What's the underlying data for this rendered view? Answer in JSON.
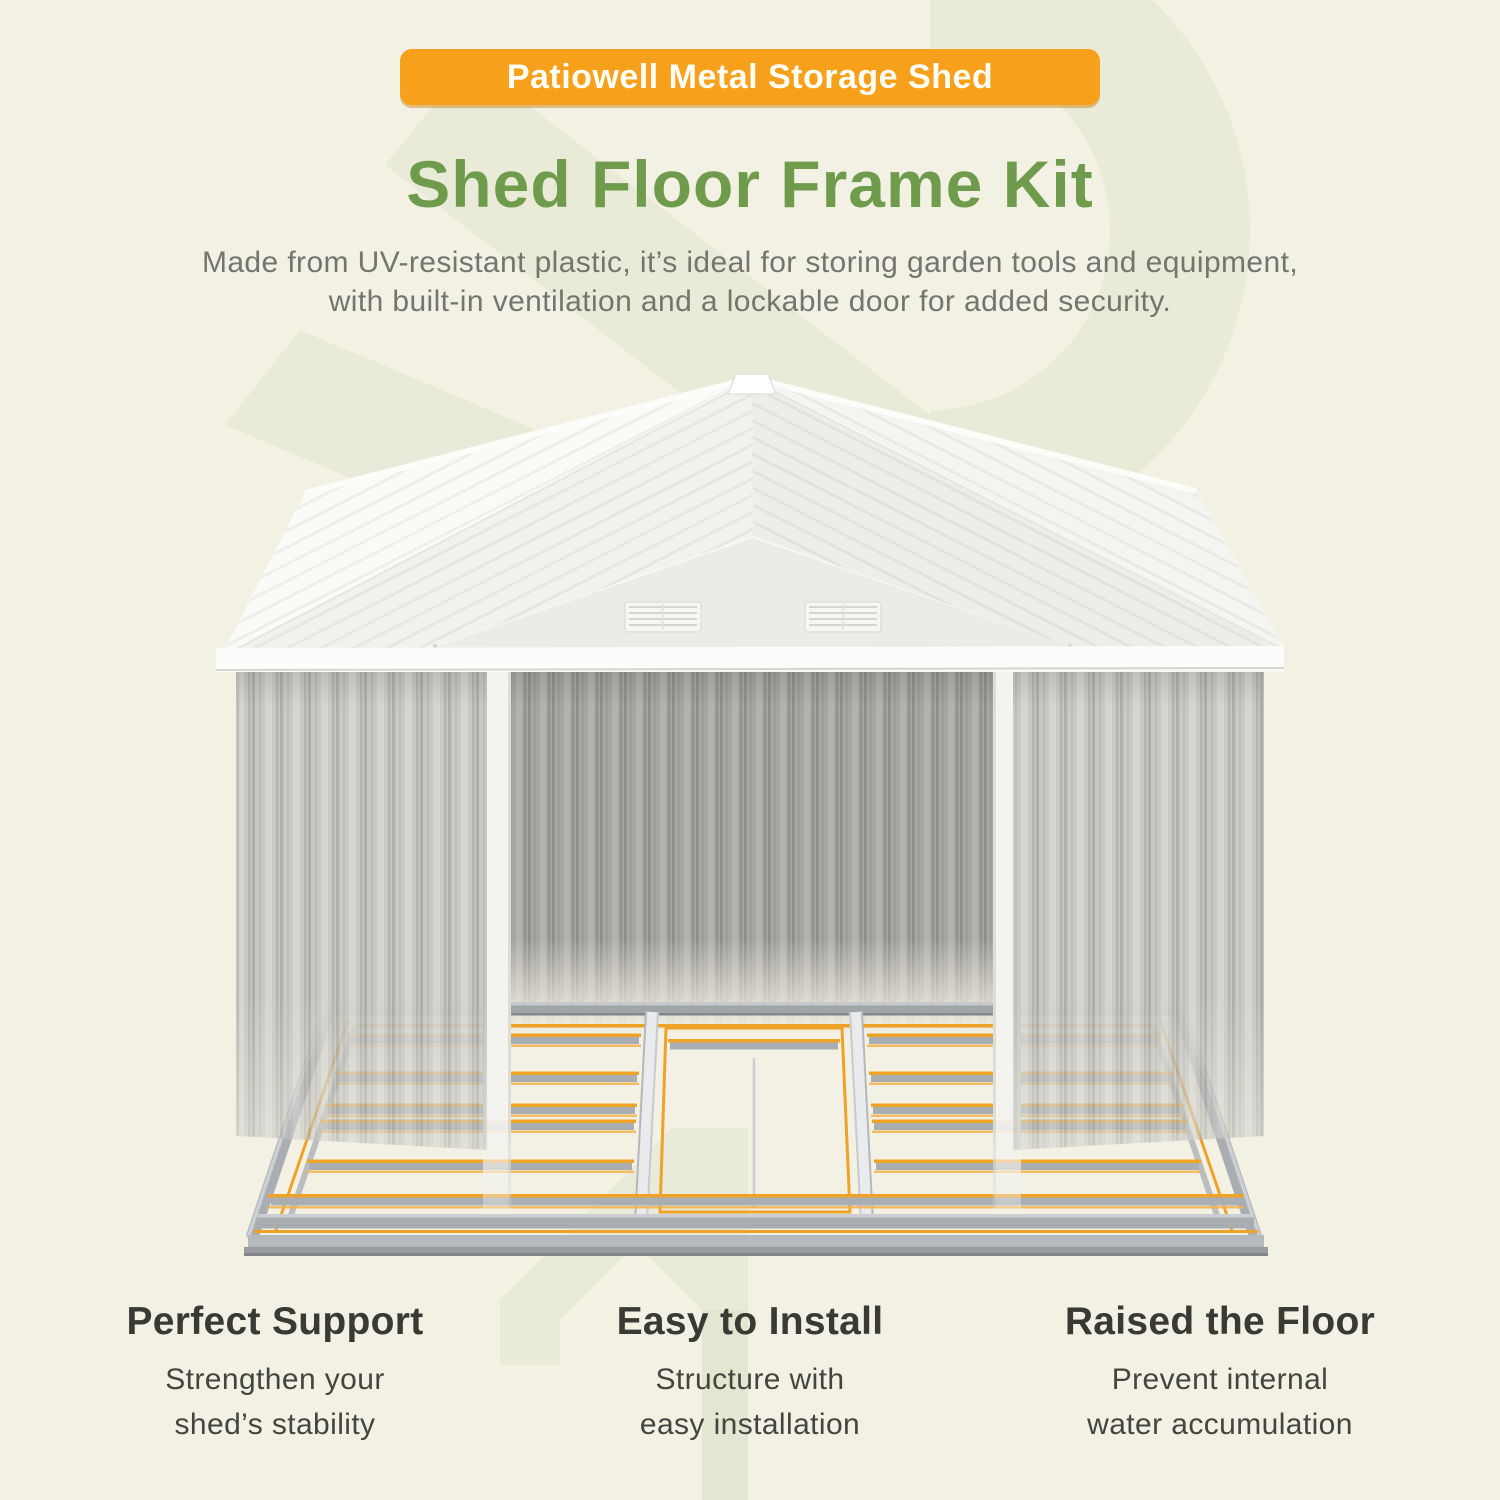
{
  "page": {
    "background_color": "#F3F1E4",
    "watermark_color": "#E9EBD8"
  },
  "badge": {
    "label": "Patiowell Metal Storage Shed",
    "background_color": "#F6A01B",
    "text_color": "#FFFDF4"
  },
  "heading": {
    "text": "Shed Floor Frame Kit",
    "color": "#6F9C4C"
  },
  "description": {
    "lines": [
      "Made from UV-resistant plastic, it’s ideal for storing garden tools and equipment,",
      "with built-in ventilation and a lockable door for added security."
    ],
    "color": "#72766E"
  },
  "illustration": {
    "name": "metal-storage-shed-with-floor-frame-kit",
    "roof_color": "#F7F7F4",
    "gable_color": "#EBEBE7",
    "wall_color": "#C8C8C4",
    "interior_wall_color": "#A6A5A0",
    "trim_color": "#F3F3F0",
    "frame_steel_color": "#A7ACB1",
    "frame_accent_color": "#EFA125",
    "vent_count": 2
  },
  "features": [
    {
      "title": "Perfect Support",
      "lines": [
        "Strengthen your",
        "shed’s stability"
      ]
    },
    {
      "title": "Easy to Install",
      "lines": [
        "Structure with",
        "easy installation"
      ]
    },
    {
      "title": "Raised the Floor",
      "lines": [
        "Prevent internal",
        "water accumulation"
      ]
    }
  ]
}
